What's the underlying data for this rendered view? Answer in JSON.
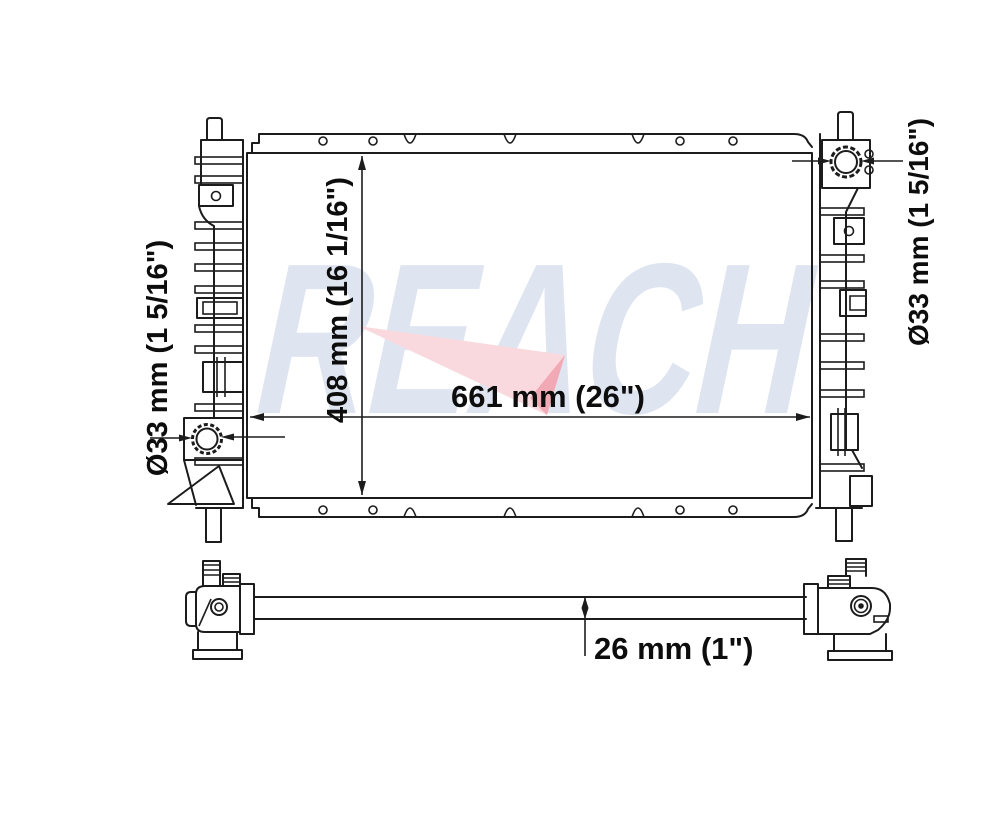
{
  "title": "Radiator dimensional diagram",
  "background_color": "#ffffff",
  "line_color": "#1c1c1c",
  "watermark": {
    "text": "REACH",
    "letter_color": "#dfe5f0",
    "swoosh_color": "#f9d9dd",
    "swoosh_tip_color": "#f1a9b5"
  },
  "labels": {
    "core_width": "661 mm (26\")",
    "core_height": "408 mm (16 1/16\")",
    "left_port_diameter": "Ø33 mm (1 5/16\")",
    "right_port_diameter": "Ø33 mm (1 5/16\")",
    "core_thickness": "26 mm (1\")"
  }
}
